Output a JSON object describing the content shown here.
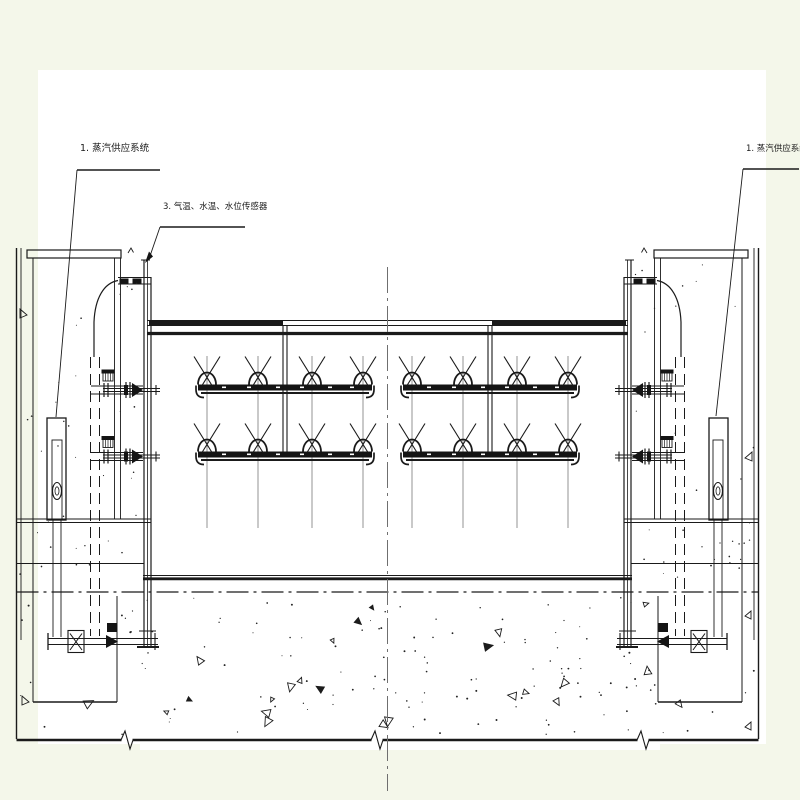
{
  "labels": {
    "steam_supply_left": {
      "text": "1. 蒸汽供应系统"
    },
    "sensors": {
      "text": "3. 气温、水温、水位传感器"
    },
    "steam_supply_right": {
      "text": "1. 蒸汽供应系统"
    }
  },
  "colors": {
    "page": "#f4f7ea",
    "paper": "#ffffff",
    "line": "#1a1a1a",
    "gray": "#6f6f6f"
  }
}
